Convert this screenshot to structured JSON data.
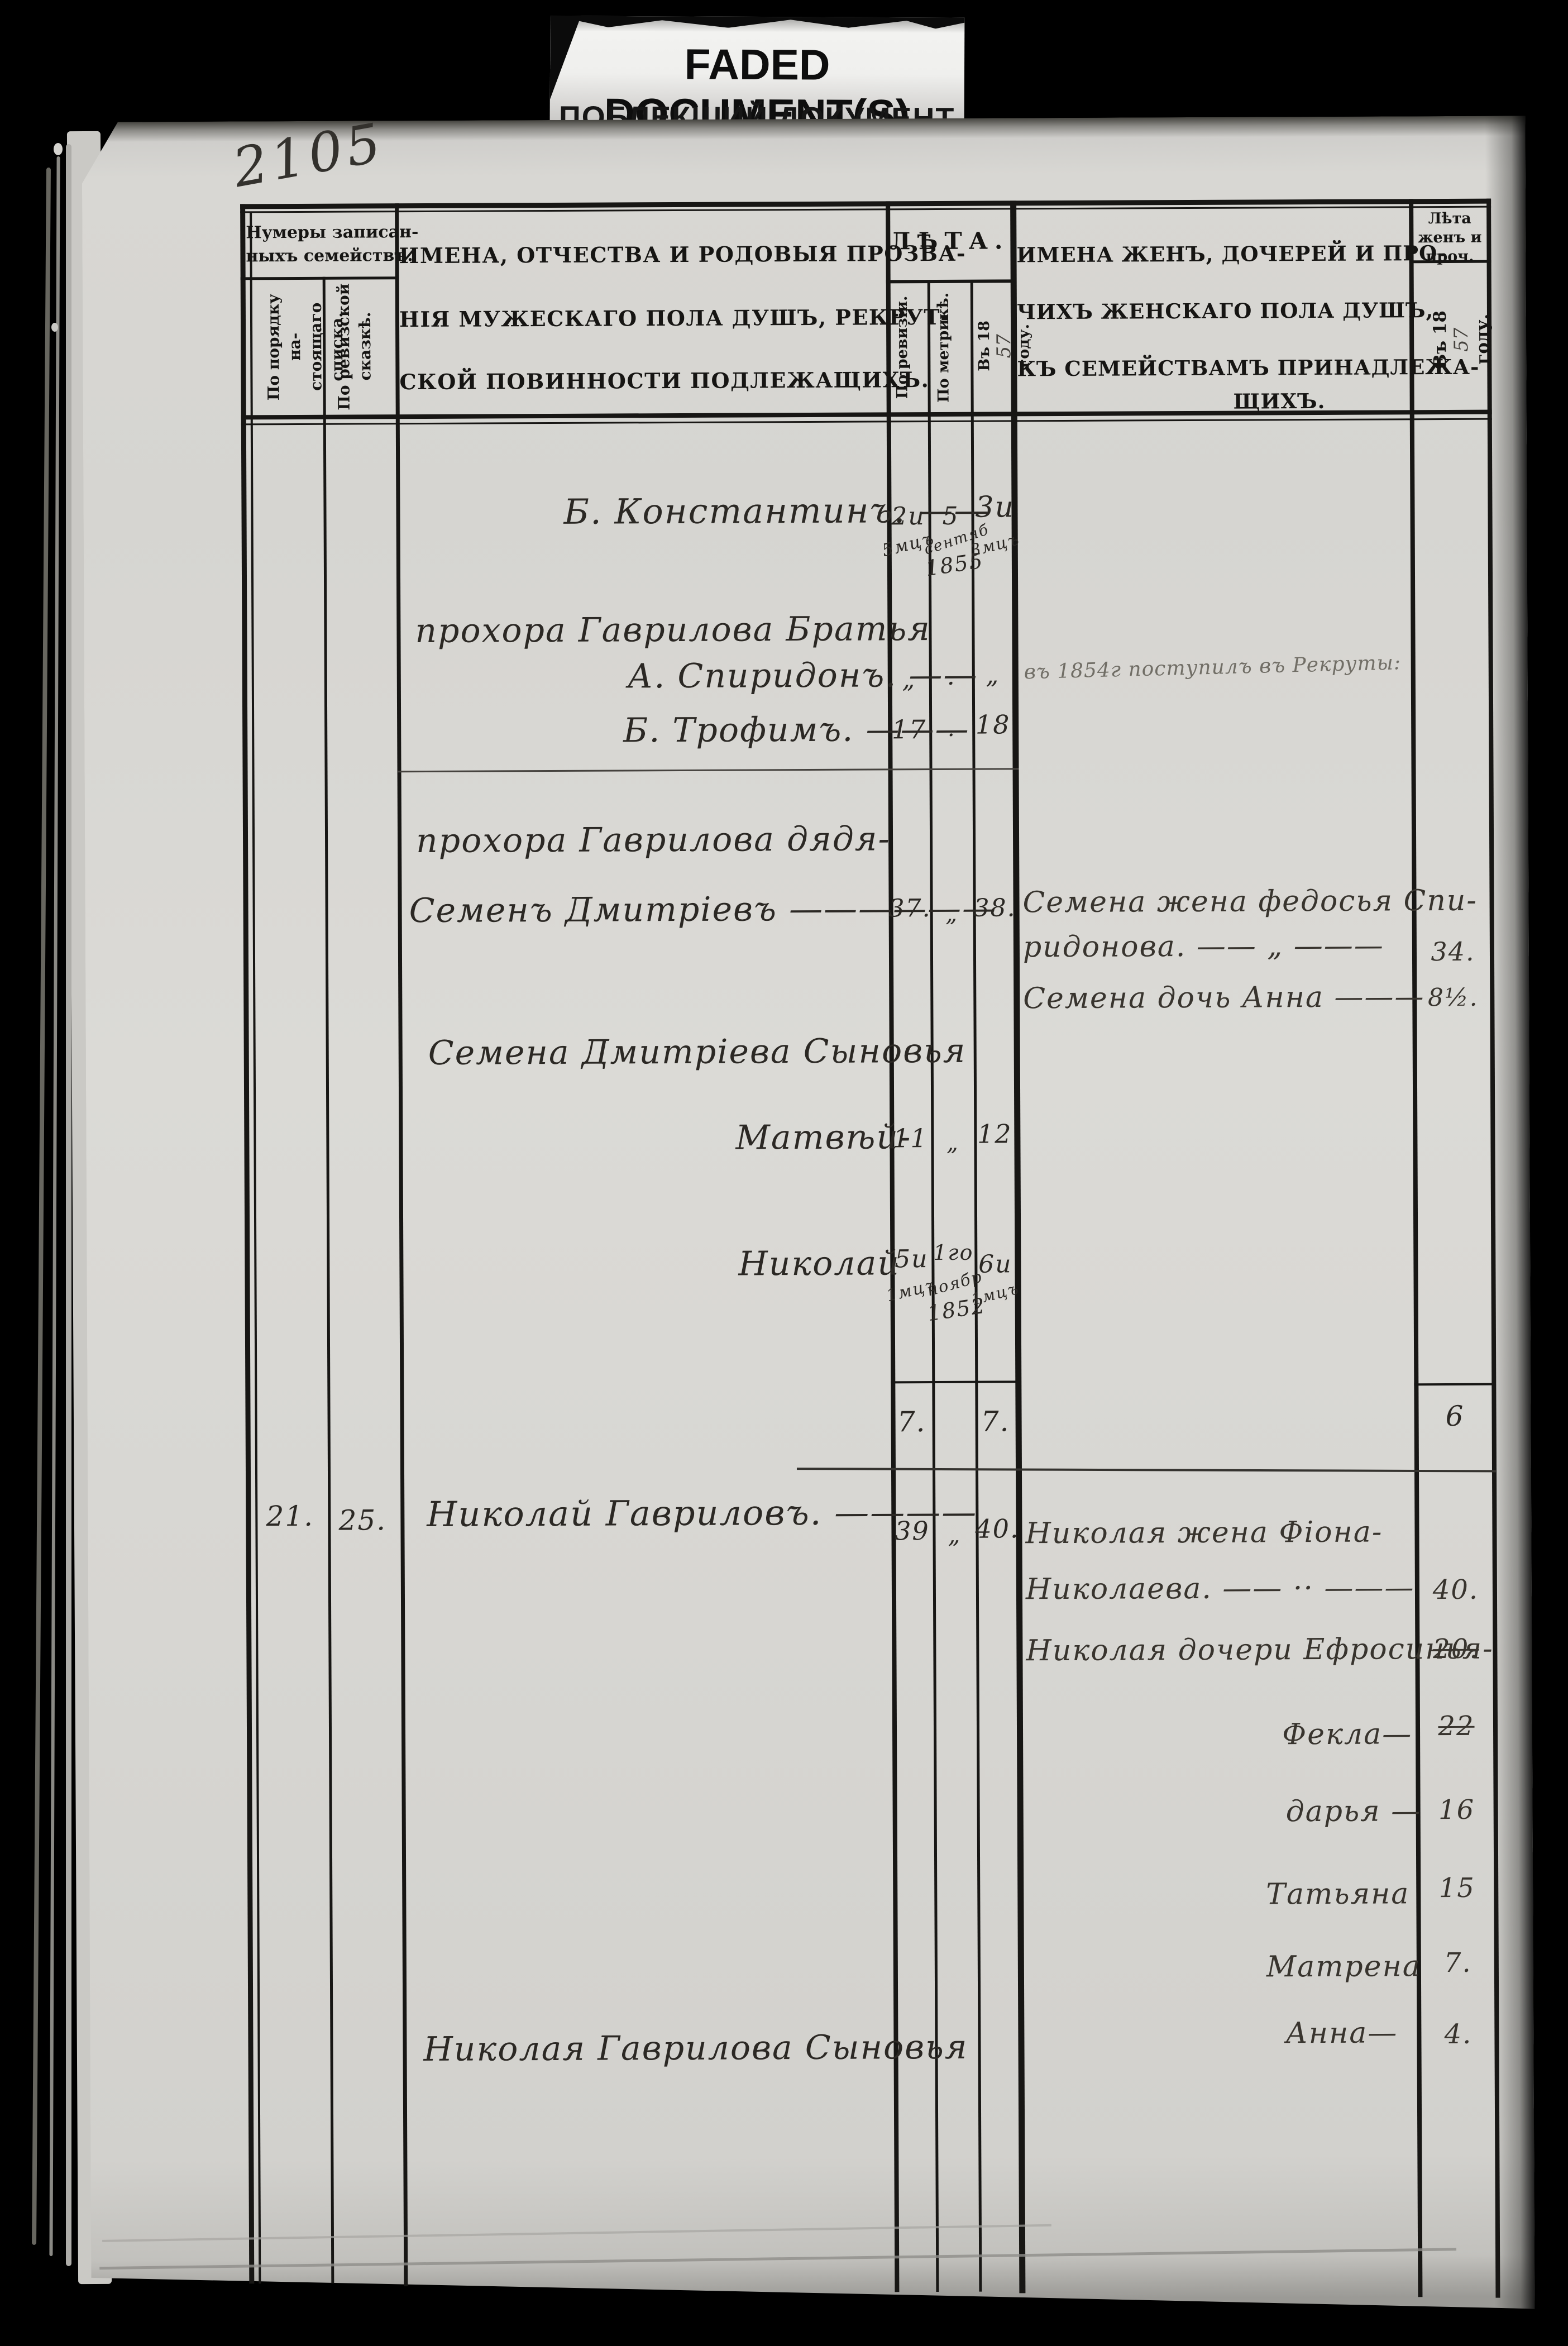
{
  "colors": {
    "background": "#000000",
    "paper": "#d8d7d3",
    "print_ink": "#161513",
    "handwriting_ink": "#2b2824",
    "banner_bg": "#f0efed"
  },
  "banner": {
    "title": "FADED DOCUMENT(S)",
    "subtitle": "ПОБЛЕКШИЙ ДОКУМЕНТ"
  },
  "page_number": "2105",
  "header": {
    "family_numbers_line1": "Нумеры записан-",
    "family_numbers_line2": "ныхъ семействъ.",
    "by_list_line1": "По порядку на-",
    "by_list_line2": "стоящаго списка.",
    "by_skazka_line1": "По ревизской",
    "by_skazka_line2": "сказкѣ.",
    "male_line1": "ИМЕНА, ОТЧЕСТВА И РОДОВЫЯ ПРОЗВА-",
    "male_line2": "НІЯ МУЖЕСКАГО ПОЛА ДУШЪ, РЕКРУТ-",
    "male_line3": "СКОЙ ПОВИННОСТИ ПОДЛЕЖАЩИХЪ.",
    "leta": "ЛѢТА.",
    "po_revizii": "По ревизіи.",
    "po_metrike": "По метрикѣ.",
    "v_year_prefix": "Въ 18",
    "v_year_hand": "57",
    "v_year_suffix": "году.",
    "female_line1": "ИМЕНА ЖЕНЪ, ДОЧЕРЕЙ И ПРО-",
    "female_line2": "ЧИХЪ ЖЕНСКАГО ПОЛА ДУШЪ,",
    "female_line3": "КЪ СЕМЕЙСТВАМЪ ПРИНАДЛЕЖА-",
    "female_line4": "ЩИХЪ.",
    "wives_leta_line1": "Лѣта",
    "wives_leta_line2": "женъ и",
    "wives_leta_line3": "проч."
  },
  "rows": {
    "konstantin": {
      "name": "Б. Константинъ. ——",
      "rev1": "2и",
      "rev2": "5мцъ",
      "metr1": "5",
      "metr2": "сентяб",
      "metr3": "1855",
      "now1": "3и",
      "now2": "3мцъ"
    },
    "prokhor_brothers_label": "прохора Гаврилова Братья",
    "spiridon": {
      "name": "А. Спиридонъ. ——",
      "rev": "„",
      "metr": "·",
      "now": "„",
      "note": "въ 1854г поступилъ въ Рекруты:"
    },
    "trofim": {
      "name": "Б. Трофимъ. ———",
      "rev": "17",
      "metr": "·",
      "now": "18"
    },
    "prokhor_uncle_label": "прохора Гаврилова дядя-",
    "semyon": {
      "name": "Семенъ Дмитріевъ ——————",
      "rev": "37.",
      "metr": "„",
      "now": "38."
    },
    "semyon_wife_line1": "Семена жена федосья Спи-",
    "semyon_wife_line2": "ридонова. —— „ ———",
    "semyon_wife_age": "34.",
    "semyon_daughter": {
      "name": "Семена дочь Анна ———",
      "age": "8½."
    },
    "semyon_sons_label": "Семена Дмитріева Сыновья",
    "matvey": {
      "name": "Матвѣй-",
      "rev": "11",
      "metr": "„",
      "now": "12"
    },
    "nikolay_jr": {
      "name": "Николай",
      "rev1": "5и",
      "rev2": "1мцъ",
      "metr1": "1го",
      "metr2": "ноябр",
      "metr3": "1852",
      "now1": "6и",
      "now2": "1мцъ"
    },
    "totals": {
      "rev": "7.",
      "now": "7.",
      "women": "6"
    },
    "family21": {
      "list_no": "21.",
      "skazka_no": "25.",
      "name": "Николай Гавриловъ. ————",
      "rev": "39",
      "metr": "„",
      "now": "40."
    },
    "nikolay_wife_line1": "Николая жена Фіона-",
    "nikolay_wife_line2": "Николаева. —— ·· ———",
    "nikolay_wife_age": "40.",
    "nikolay_daughters": {
      "label": "Николая дочери Ефросинья-",
      "age": "20."
    },
    "fekla": {
      "name": "Фекла—",
      "age": "22"
    },
    "darya": {
      "name": "дарья —",
      "age": "16"
    },
    "tatyana": {
      "name": "Татьяна",
      "age": "15"
    },
    "matrena": {
      "name": "Матрена",
      "age": "7."
    },
    "nikolay_sons_label": "Николая Гаврилова Сыновья",
    "anna": {
      "name": "Анна—",
      "age": "4."
    }
  }
}
